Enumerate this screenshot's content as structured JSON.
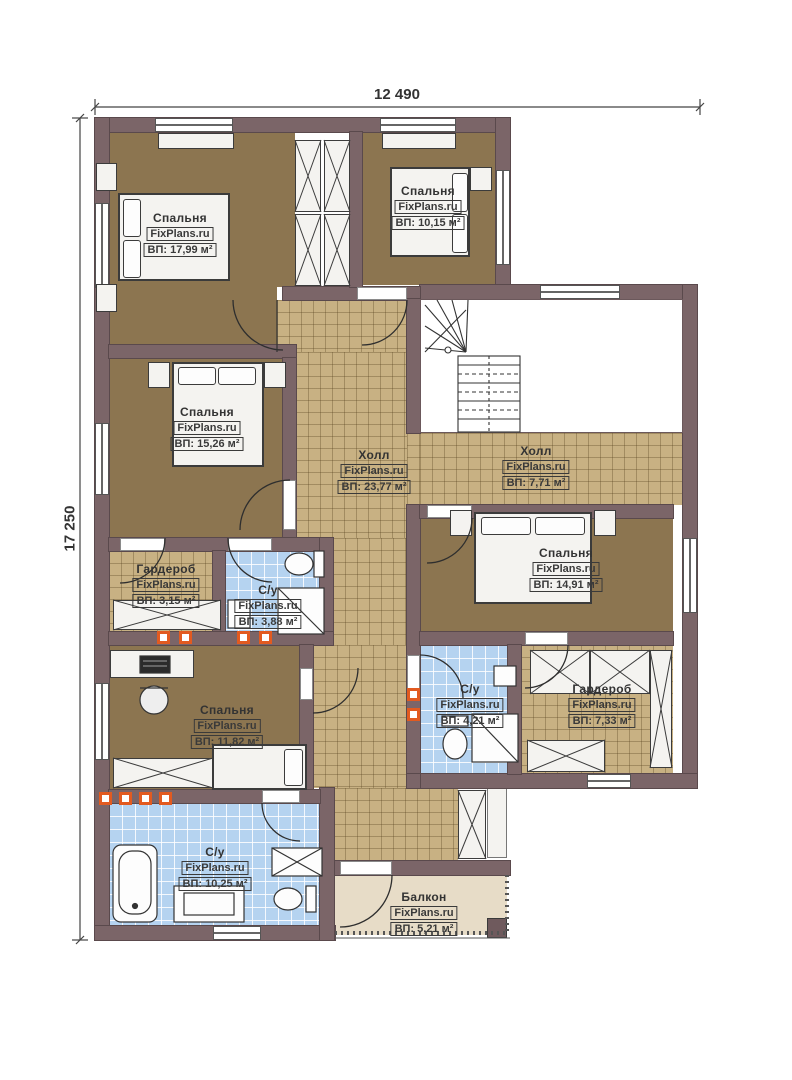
{
  "brand": "FixPlans.ru",
  "dimensions": {
    "width_label": "12 490",
    "height_label": "17 250"
  },
  "rooms": [
    {
      "name": "Спальня",
      "area": "ВП: 17,99 м²"
    },
    {
      "name": "Спальня",
      "area": "ВП: 10,15 м²"
    },
    {
      "name": "Спальня",
      "area": "ВП: 15,26 м²"
    },
    {
      "name": "Холл",
      "area": "ВП: 23,77 м²"
    },
    {
      "name": "Холл",
      "area": "ВП: 7,71 м²"
    },
    {
      "name": "Спальня",
      "area": "ВП: 14,91 м²"
    },
    {
      "name": "Гардероб",
      "area": "ВП: 3,15 м²"
    },
    {
      "name": "С/у",
      "area": "ВП: 3,88 м²"
    },
    {
      "name": "Спальня",
      "area": "ВП: 11,82 м²"
    },
    {
      "name": "С/у",
      "area": "ВП: 4,21 м²"
    },
    {
      "name": "Гардероб",
      "area": "ВП: 7,33 м²"
    },
    {
      "name": "С/у",
      "area": "ВП: 10,25 м²"
    },
    {
      "name": "Балкон",
      "area": "ВП: 5,21 м²"
    }
  ],
  "colors": {
    "wall": "#7b6568",
    "bedroom_floor": "#8c7550",
    "hall_tile": "#c8b183",
    "bath_tile": "#b5d3f0",
    "balcony_floor": "#e7dcc7",
    "marker": "#e25a20"
  }
}
